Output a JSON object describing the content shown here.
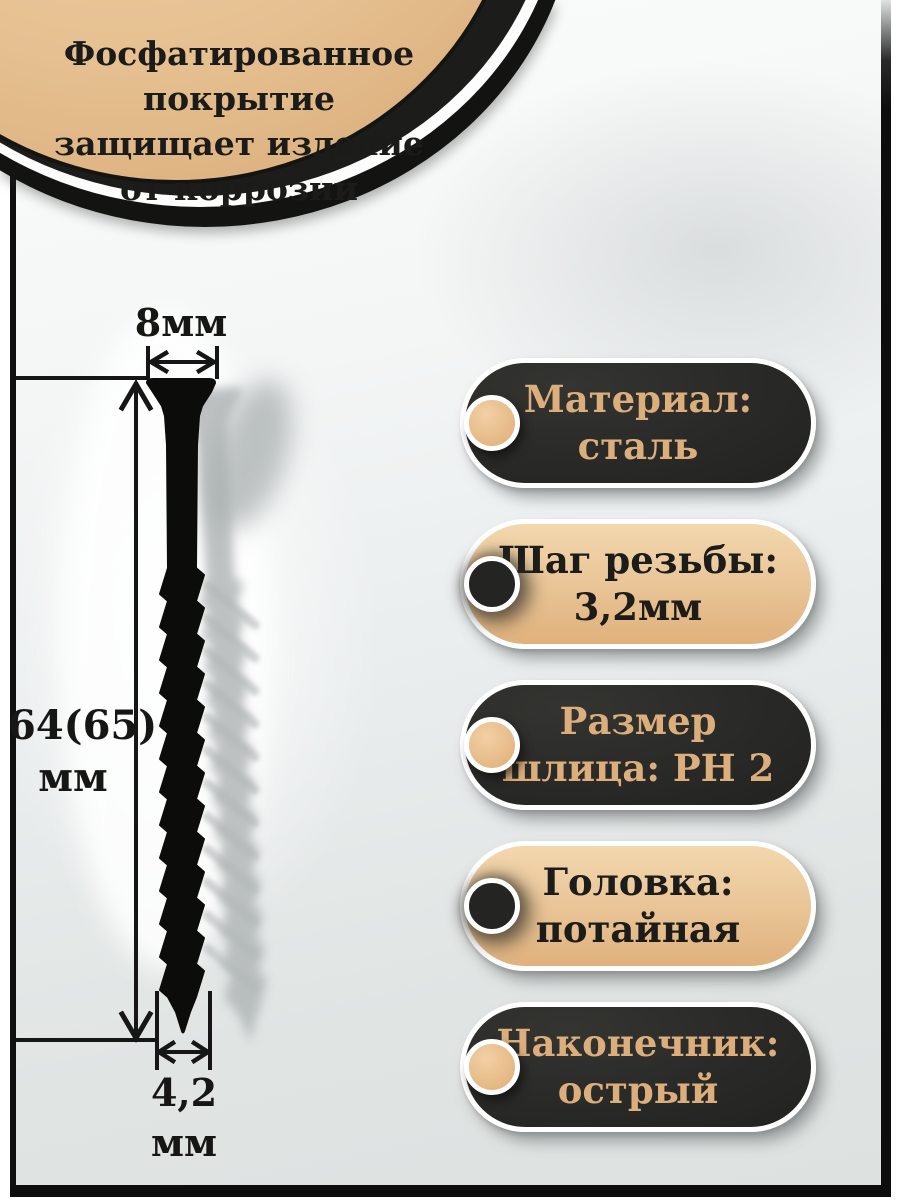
{
  "callout": {
    "lines": [
      "Фосфатированное покрытие",
      "защищает изделие",
      "от коррозии"
    ]
  },
  "dimensions": {
    "head_width": {
      "label": "8мм"
    },
    "length": {
      "value": "64(65)",
      "unit": "мм"
    },
    "tip_diameter": {
      "value": "4,2",
      "unit": "мм"
    }
  },
  "specs": [
    {
      "line1": "Материал:",
      "line2": "сталь",
      "style": "dark"
    },
    {
      "line1": "Шаг резьбы:",
      "line2": "3,2мм",
      "style": "beige"
    },
    {
      "line1": "Размер",
      "line2": "шлица: PH 2",
      "style": "dark"
    },
    {
      "line1": "Головка:",
      "line2": "потайная",
      "style": "beige"
    },
    {
      "line1": "Наконечник:",
      "line2": "острый",
      "style": "dark"
    }
  ],
  "colors": {
    "beige": "#e8c497",
    "beige_light": "#f3d7ad",
    "dark": "#272725",
    "beige_text": "#dcae7c",
    "dark_text": "#1c1c1a",
    "photo_gray": "#e0e4e3",
    "frame": "#0d0d0d",
    "background": "#ffffff",
    "dimension_line": "#161616"
  }
}
